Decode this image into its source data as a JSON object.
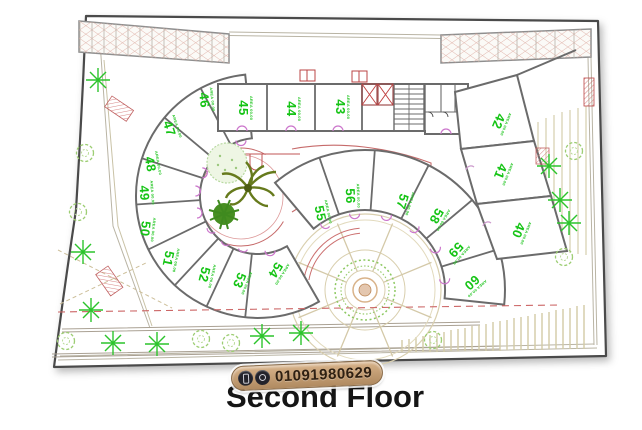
{
  "title": "Second Floor",
  "badge": {
    "phone": "01091980629",
    "icons": [
      "phone-icon",
      "whatsapp-icon"
    ]
  },
  "plan": {
    "area_label": "AREA 00.00",
    "rooms": [
      {
        "number": "40"
      },
      {
        "number": "41"
      },
      {
        "number": "42"
      },
      {
        "number": "43"
      },
      {
        "number": "44"
      },
      {
        "number": "45"
      },
      {
        "number": "46"
      },
      {
        "number": "47"
      },
      {
        "number": "48"
      },
      {
        "number": "49"
      },
      {
        "number": "50"
      },
      {
        "number": "51"
      },
      {
        "number": "52"
      },
      {
        "number": "53"
      },
      {
        "number": "54"
      },
      {
        "number": "55"
      },
      {
        "number": "56"
      },
      {
        "number": "57"
      },
      {
        "number": "58"
      },
      {
        "number": "59"
      },
      {
        "number": "60"
      }
    ]
  },
  "colors": {
    "room_number_green": "#15c415",
    "wall_gray": "#6b6b6b",
    "detail_red": "#c05555",
    "door_magenta": "#cc77cc",
    "tree_green": "#2cc42c",
    "hatch_tan": "#d6cfae",
    "badge_tan": "#c8a276",
    "title_black": "#151515"
  }
}
